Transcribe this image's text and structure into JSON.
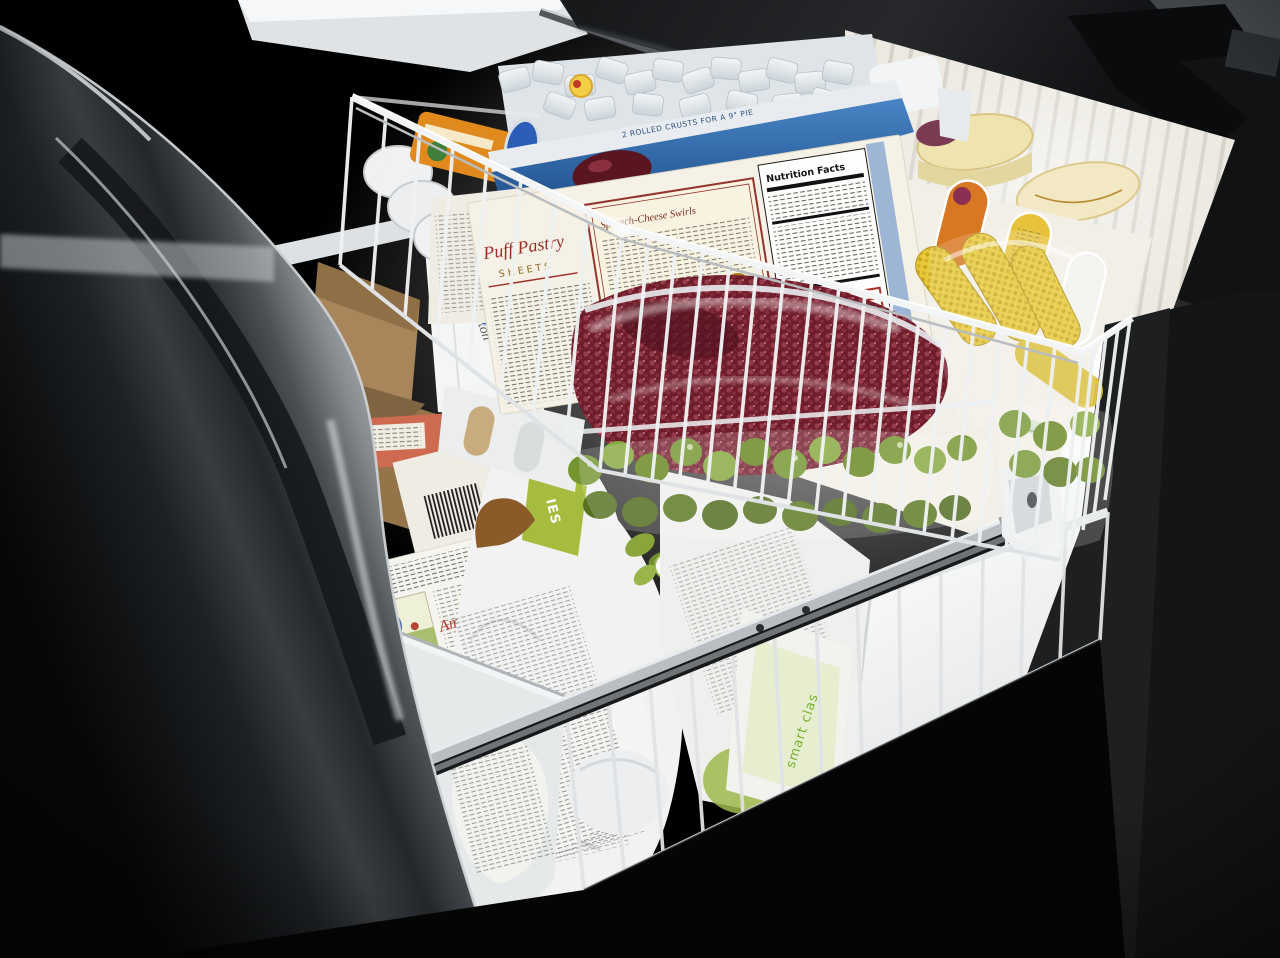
{
  "scene": {
    "description": "Photograph: pulled-out bottom freezer drawer of a black stainless refrigerator, interior light on, two white wire baskets filled with frozen food",
    "camera": "three-quarter view from above, drawer front at left, dark surround"
  },
  "labels": {
    "puff_brand": "Puff Pastry",
    "puff_type": "SHEETS",
    "recipe_title": "Spinach-Cheese Swirls",
    "nutrition_title": "Nutrition Facts",
    "pie_box_edge": "2 ROLLED CRUSTS FOR A 9\" PIE",
    "amys_logo": "Amy's",
    "smart_bag": "smart clas",
    "net_weight": "NET WT 26 OZ (1.5 LB)",
    "badge_number": "10",
    "badge_unit": "min",
    "green_band_letters": "IES",
    "black_patch_letters": "VA",
    "handwriting": "ton"
  },
  "items": [
    {
      "name": "ice-cube-bin",
      "color": "#e7ebee"
    },
    {
      "name": "juice-concentrate-can-orange",
      "color": "#e08a1d",
      "cap": "#2b5cb8"
    },
    {
      "name": "juice-concentrate-can-red",
      "color": "#b23a2f"
    },
    {
      "name": "stacked-can-lids",
      "color": "#f0f1f2"
    },
    {
      "name": "puff-pastry-box",
      "color": "#f5f1e6"
    },
    {
      "name": "pie-crust-box",
      "color": "#2f6fb5"
    },
    {
      "name": "frozen-berries-bag",
      "color": "#6f1d2b"
    },
    {
      "name": "corn-on-cob-bag",
      "color": "#e2c435"
    },
    {
      "name": "brussels-sprouts-bags",
      "color": "#74952f"
    },
    {
      "name": "ice-cream-tubs",
      "color": "#efe3b0"
    },
    {
      "name": "divider-panel-with-ovals",
      "color": "#f2efe7"
    },
    {
      "name": "kraft-paper-packages",
      "color": "#9a7b4e"
    },
    {
      "name": "wrapped-package-with-handwriting",
      "color": "#f4f5f5"
    },
    {
      "name": "amys-entree-boxes",
      "color": "#f6f4ee"
    },
    {
      "name": "veggie-bag-green-band",
      "color": "#a5bc3f"
    },
    {
      "name": "smart-bag",
      "color": "#7ab22e"
    },
    {
      "name": "drawer-slide-rail",
      "color": "#b9bec2"
    },
    {
      "name": "freezer-liner-wall",
      "color": "#fdfdfd"
    },
    {
      "name": "drawer-front-panel",
      "color": "#8a8f93"
    }
  ],
  "colors": {
    "background": "#000000",
    "door_dark": "#202225",
    "wire": "#eef1f2",
    "amys_red": "#b5382e",
    "smart_green": "#76b02c",
    "recipe_red": "#93332c",
    "ice": "#e7ebee"
  }
}
